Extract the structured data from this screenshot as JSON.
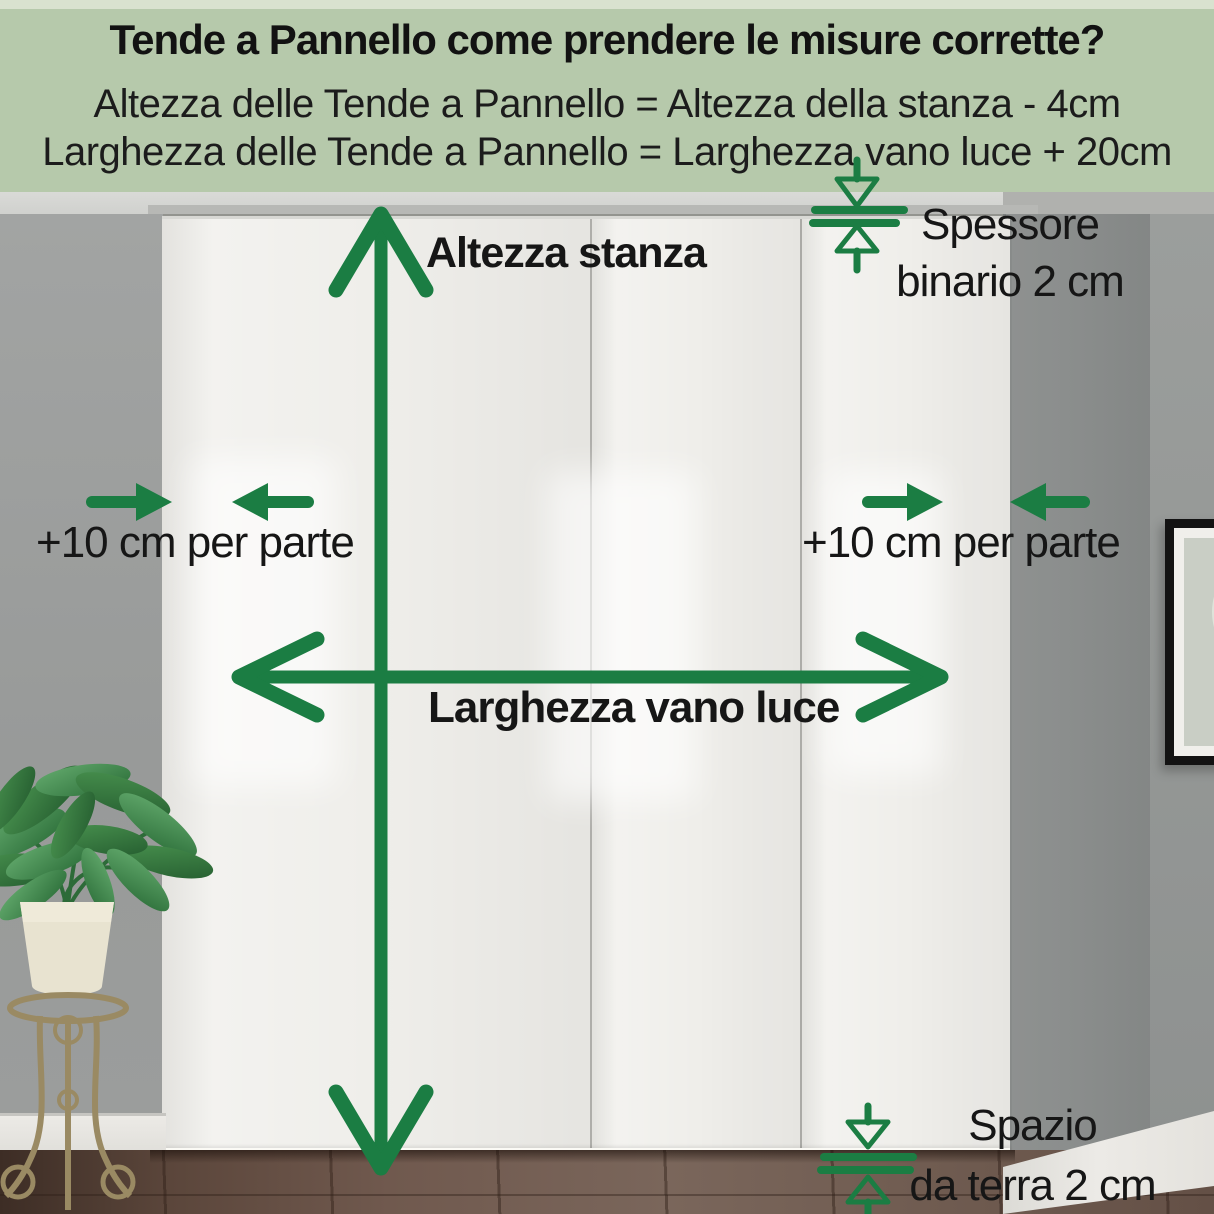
{
  "header": {
    "title": "Tende a Pannello come prendere le misure corrette?",
    "formula_height": "Altezza delle Tende a Pannello = Altezza della stanza - 4cm",
    "formula_width": "Larghezza delle Tende a Pannello = Larghezza vano luce + 20cm"
  },
  "annotations": {
    "room_height": "Altezza stanza",
    "opening_width": "Larghezza vano luce",
    "side_margin_left": "+10 cm per parte",
    "side_margin_right": "+10 cm per parte",
    "rail_thickness_line1": "Spessore",
    "rail_thickness_line2": "binario 2 cm",
    "floor_gap_line1": "Spazio",
    "floor_gap_line2": "da terra 2 cm"
  },
  "colors": {
    "header_background": "#b6c9ab",
    "annotation_green": "#1b7d43",
    "label_text": "#161616",
    "curtain": "#efeeea",
    "wall_left": "#9b9d9c",
    "wall_right": "#8b8e8d",
    "floor_brown": "#6f5b50"
  }
}
